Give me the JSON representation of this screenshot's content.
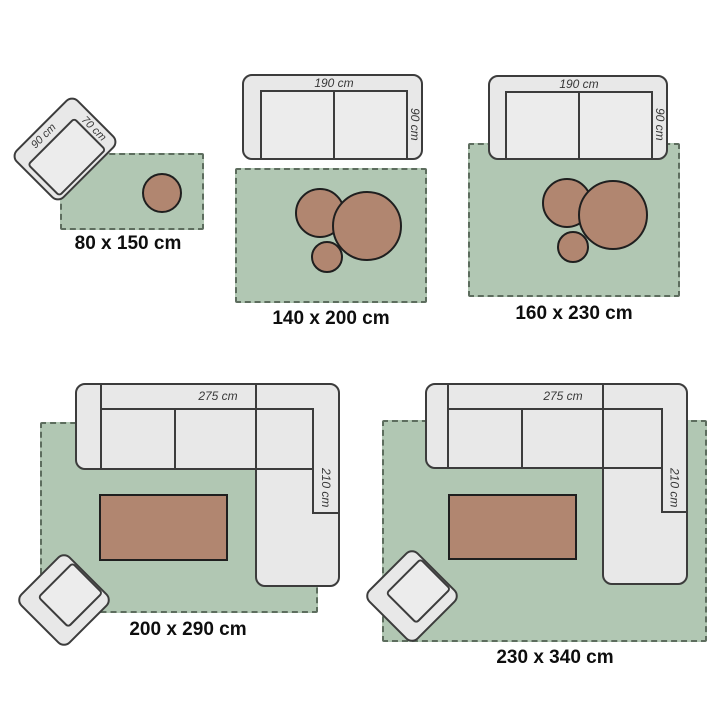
{
  "palette": {
    "background": "#ffffff",
    "rug_fill": "#b1c7b3",
    "rug_edge": "#5d6d5e",
    "furniture_fill": "#e8e8e8",
    "furniture_edge": "#3c3c3c",
    "terracotta_fill": "#b18670",
    "terracotta_edge": "#1f1f1f",
    "dimension_text": "#383838",
    "size_text": "#0e0e0e"
  },
  "groups": [
    {
      "id": "rug-80x150",
      "size_label": "80 x 150 cm",
      "armchair": {
        "width_label": "90 cm",
        "depth_label": "70 cm"
      }
    },
    {
      "id": "rug-140x200",
      "size_label": "140 x 200 cm",
      "sofa": {
        "width_label": "190 cm",
        "depth_label": "90 cm"
      }
    },
    {
      "id": "rug-160x230",
      "size_label": "160 x 230 cm",
      "sofa": {
        "width_label": "190 cm",
        "depth_label": "90 cm"
      }
    },
    {
      "id": "rug-200x290",
      "size_label": "200 x 290 cm",
      "sofa": {
        "width_label": "275 cm",
        "depth_label": "210 cm"
      }
    },
    {
      "id": "rug-230x340",
      "size_label": "230 x 340 cm",
      "sofa": {
        "width_label": "275 cm",
        "depth_label": "210 cm"
      }
    }
  ]
}
